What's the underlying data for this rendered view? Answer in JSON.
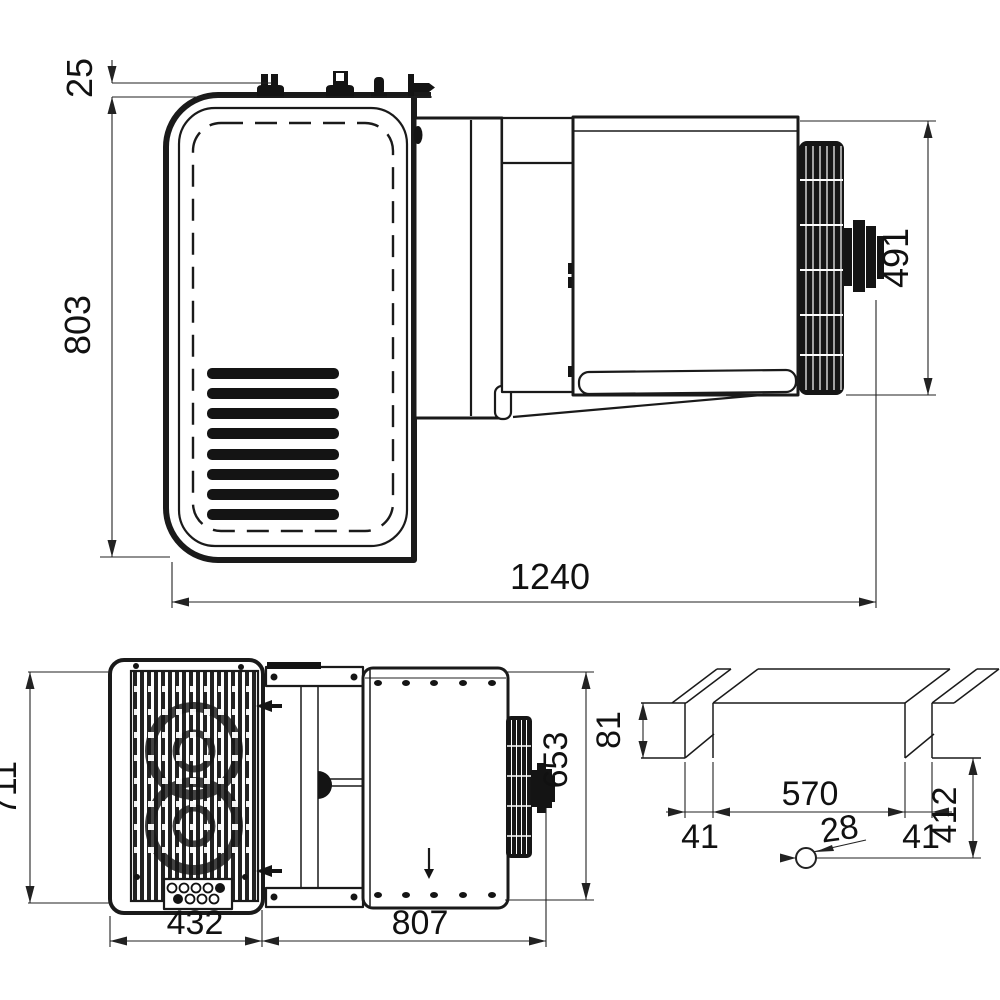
{
  "dimensions": {
    "top_view": {
      "fitting_offset": "25",
      "depth": "803",
      "overall_width": "1240",
      "unit_height": "491"
    },
    "front_view": {
      "height": "711",
      "width": "432"
    },
    "side_view": {
      "height": "653",
      "length": "807"
    },
    "wall_cutout": {
      "top_height": "81",
      "opening_width": "570",
      "left_margin": "41",
      "right_margin": "41",
      "bottom_height": "412",
      "hole_diameter": "28"
    }
  }
}
